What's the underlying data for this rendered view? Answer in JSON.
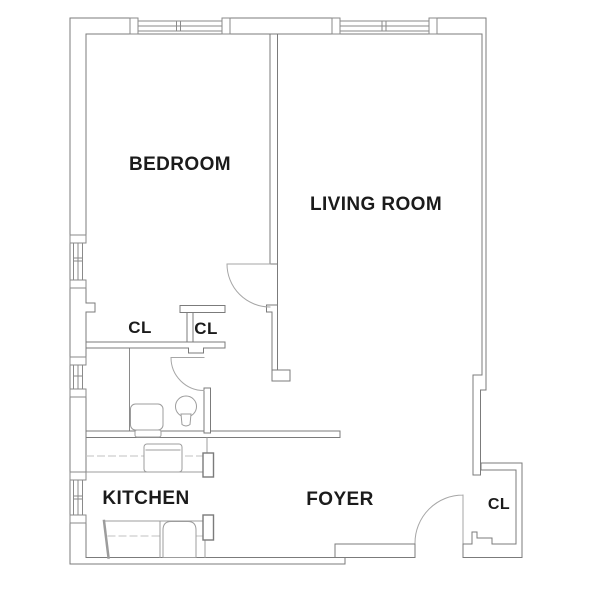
{
  "floorplan": {
    "type": "apartment-floor-plan",
    "rooms": [
      {
        "id": "bedroom",
        "label": "BEDROOM"
      },
      {
        "id": "living-room",
        "label": "LIVING ROOM"
      },
      {
        "id": "closet-bedroom",
        "label": "CL"
      },
      {
        "id": "closet-hall",
        "label": "CL"
      },
      {
        "id": "kitchen",
        "label": "KITCHEN"
      },
      {
        "id": "foyer",
        "label": "FOYER"
      },
      {
        "id": "closet-entry",
        "label": "CL"
      }
    ],
    "colors": {
      "background": "#ffffff",
      "wall_line": "#7b7b7b",
      "window_line": "#8a8a8a",
      "door_line": "#a6a6a6",
      "fixture_line": "#9c9c9c",
      "dashed_line": "#c2c2c2",
      "label_text": "#1b1b1b"
    }
  }
}
